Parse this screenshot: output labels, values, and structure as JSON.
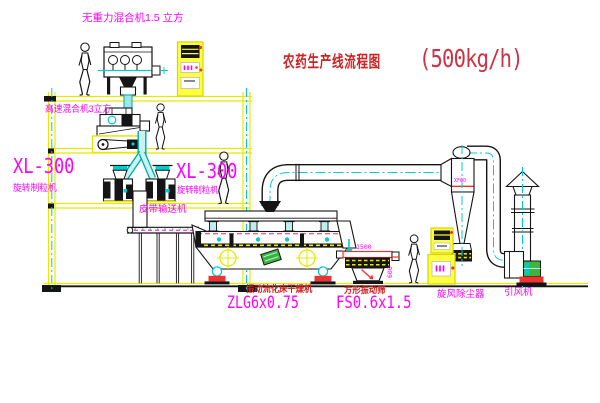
{
  "title": {
    "name": "农药生产线流程图",
    "capacity": "(500kg/h)"
  },
  "equipment_labels": {
    "gravity_mixer": "无重力混合机1.5 立方",
    "high_speed_mixer": "高速混合机3立方",
    "granulator_left": {
      "model": "XL-300",
      "name": "旋转制粒机"
    },
    "granulator_mid": {
      "model": "XL-300",
      "name": "旋转制粒机"
    },
    "belt_conveyor": "皮带输送机",
    "fluid_bed_dryer": {
      "name": "振动流化床干燥机",
      "model": "ZLG6x0.75"
    },
    "vibrating_screen": {
      "name": "方形振动筛",
      "model": "FS0.6x1.5"
    },
    "cyclone": "旋风除尘器",
    "cyclone_model": "XF00",
    "induced_draft_fan": "引风机"
  },
  "dimensions": {
    "screen_length": "1500",
    "screen_width": "600"
  },
  "colors": {
    "structure_yellow": "#e8e800",
    "machine_black": "#151515",
    "duct_cyan": "#00cccc",
    "label_magenta": "#ff00ff",
    "label_red": "#cc2222",
    "accent_red": "#ee3333",
    "motor_green": "#3db53d"
  }
}
